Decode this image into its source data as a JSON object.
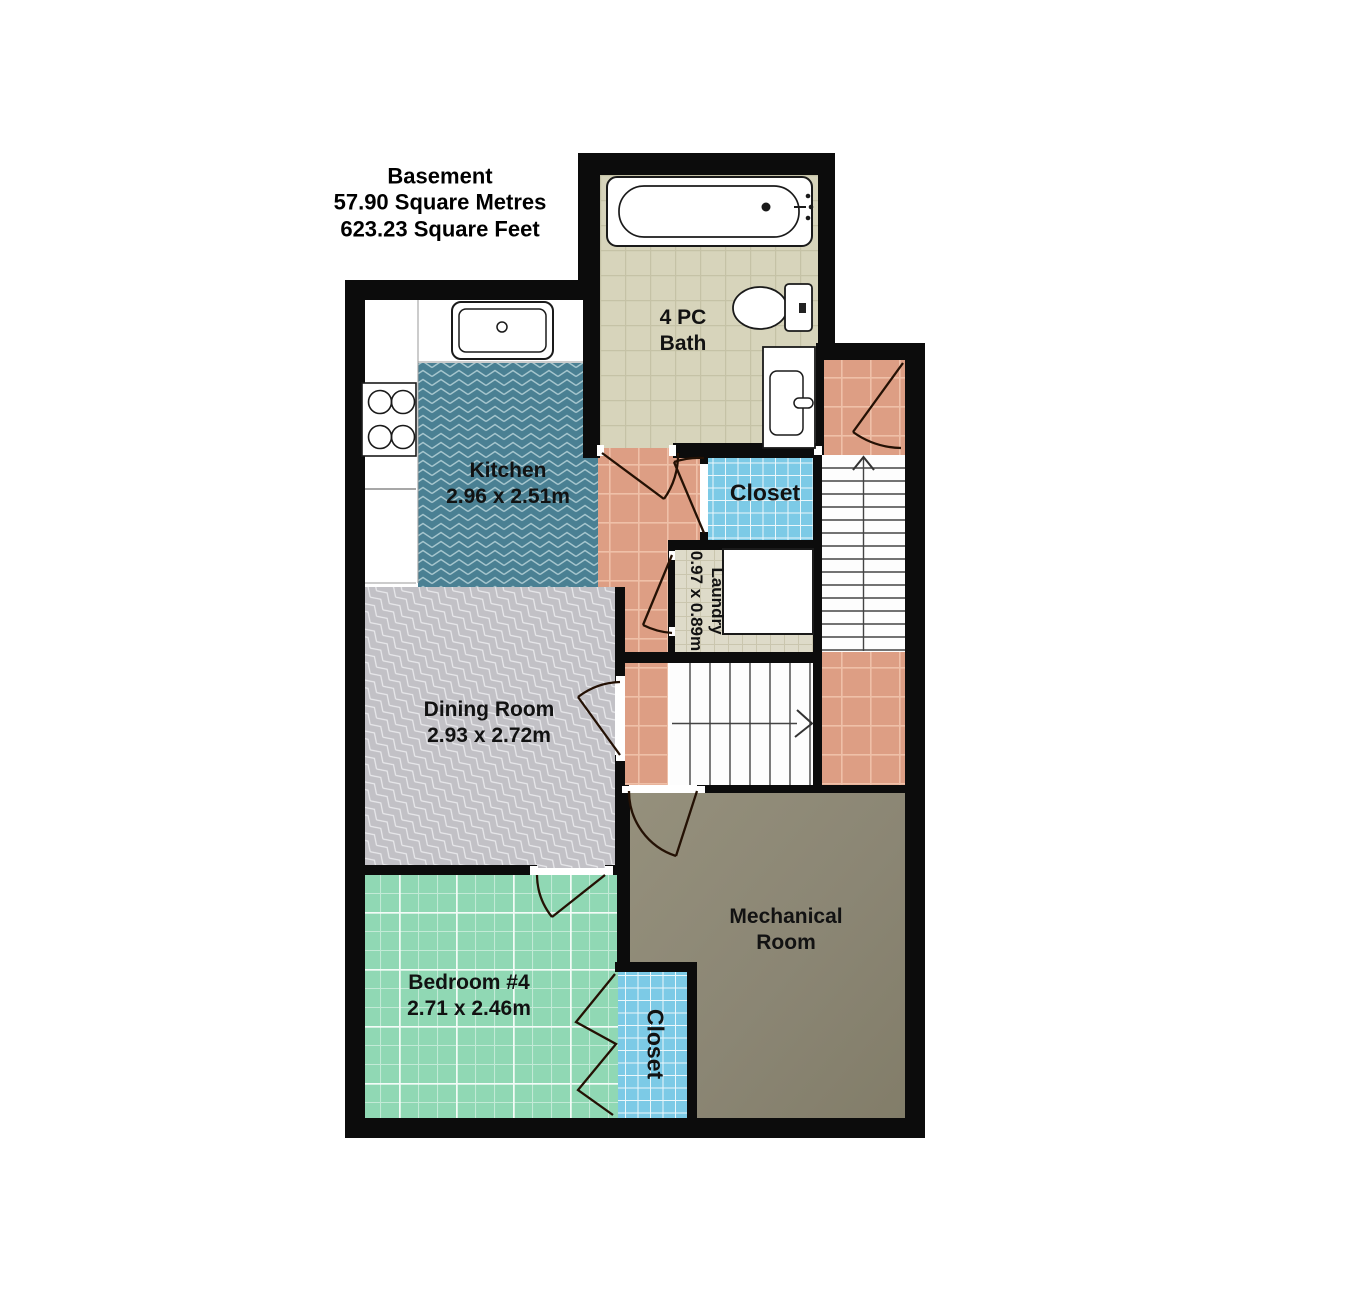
{
  "title": {
    "line1": "Basement",
    "line2": "57.90 Square Metres",
    "line3": "623.23 Square Feet"
  },
  "rooms": {
    "bath": {
      "line1": "4 PC",
      "line2": "Bath"
    },
    "kitchen": {
      "name": "Kitchen",
      "dims": "2.96 x 2.51m"
    },
    "closet_hall": {
      "name": "Closet"
    },
    "laundry": {
      "name": "Laundry",
      "dims": "0.97 x 0.89m"
    },
    "dining": {
      "name": "Dining Room",
      "dims": "2.93 x 2.72m"
    },
    "mechanical": {
      "line1": "Mechanical",
      "line2": "Room"
    },
    "bedroom": {
      "name": "Bedroom #4",
      "dims": "2.71 x 2.46m"
    },
    "closet_bedroom": {
      "name": "Closet"
    }
  },
  "colors": {
    "wall": "#0c0c0c",
    "bath_tile": "#d7d4bb",
    "hall_tile_salmon": "#dd9e84",
    "closet_tile_blue": "#7ccae6",
    "kitchen_teal": "#4a8093",
    "dining_gray": "#c2c1c6",
    "bedroom_mint": "#90d8b4",
    "laundry_tile": "#dedbc9",
    "mechanical_olive": "#8b8674",
    "label_text": "#121212"
  }
}
